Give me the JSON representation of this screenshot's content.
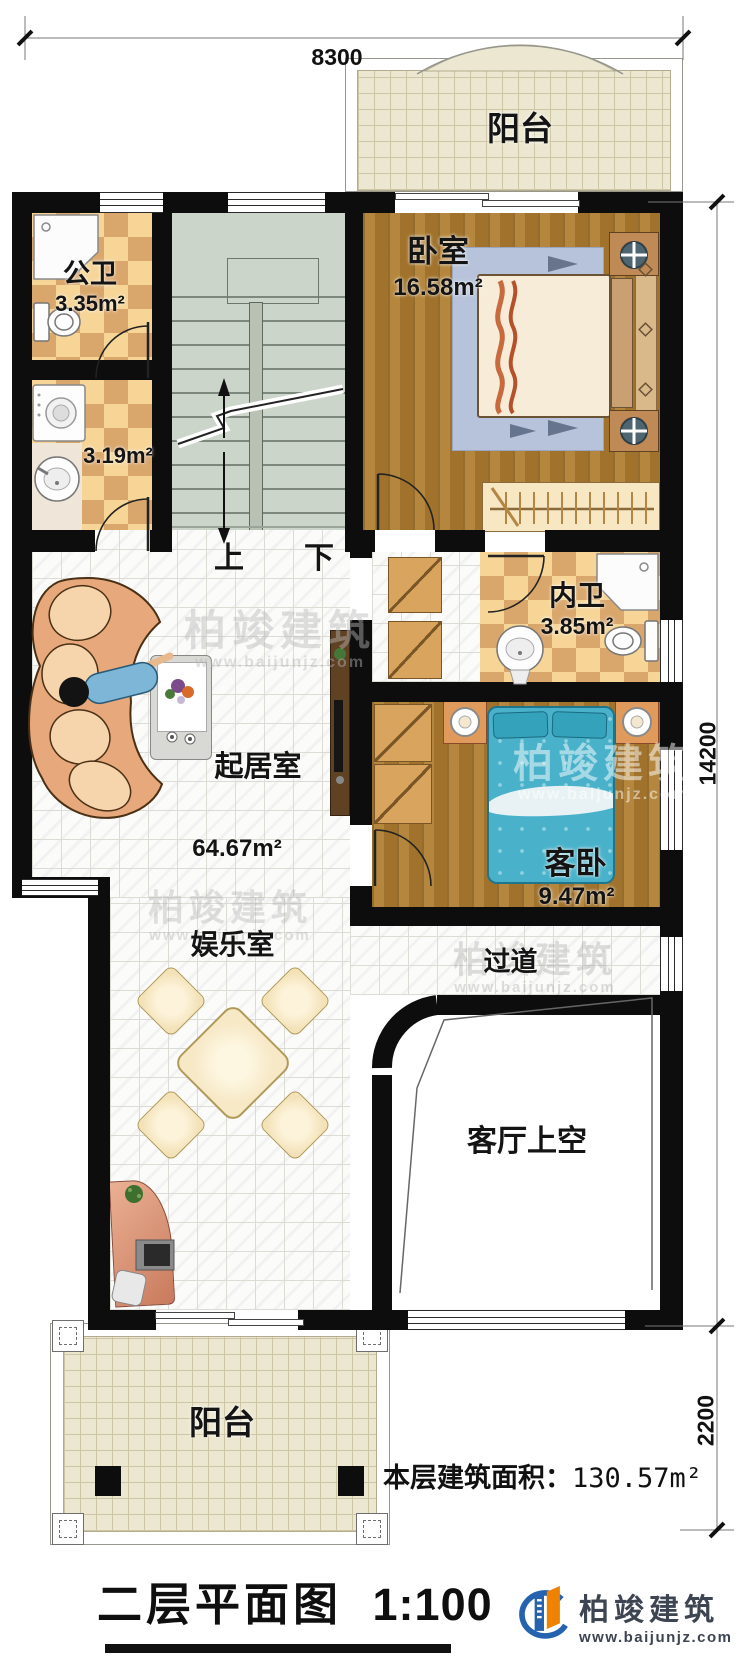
{
  "dimensions": {
    "top": "8300",
    "side": "14200",
    "balcony": "2200"
  },
  "rooms": {
    "balcony_top": {
      "label": "阳台"
    },
    "bedroom": {
      "label": "卧室",
      "area": "16.58m²"
    },
    "public_bath": {
      "label": "公卫",
      "area": "3.35m²"
    },
    "laundry": {
      "area": "3.19m²"
    },
    "inner_bath": {
      "label": "内卫",
      "area": "3.85m²"
    },
    "living": {
      "label": "起居室",
      "area": "64.67m²"
    },
    "guest_bedroom": {
      "label": "客卧",
      "area": "9.47m²"
    },
    "entertainment": {
      "label": "娱乐室"
    },
    "hallway": {
      "label": "过道"
    },
    "void": {
      "label": "客厅上空"
    },
    "balcony_bottom": {
      "label": "阳台"
    }
  },
  "stairs": {
    "up": "上",
    "down": "下"
  },
  "summary": {
    "label": "本层建筑面积：",
    "value": "130.57m²"
  },
  "title": {
    "name": "二层平面图",
    "scale": "1:100"
  },
  "brand": {
    "name": "柏竣建筑",
    "url": "www.baijunjz.com"
  },
  "watermark": {
    "name": "柏竣建筑",
    "url": "www.baijunjz.com"
  },
  "colors": {
    "wall": "#0d0d0d",
    "wood": "#a9782e",
    "tile_light": "#f6d597",
    "tile_dark": "#d9a76c",
    "stair": "#ccd5ca",
    "balcony": "#ece7d0",
    "bed_blue": "#49b2ca",
    "sofa": "#e7a87c",
    "brand_blue": "#2563ae",
    "brand_orange": "#ef8200"
  }
}
